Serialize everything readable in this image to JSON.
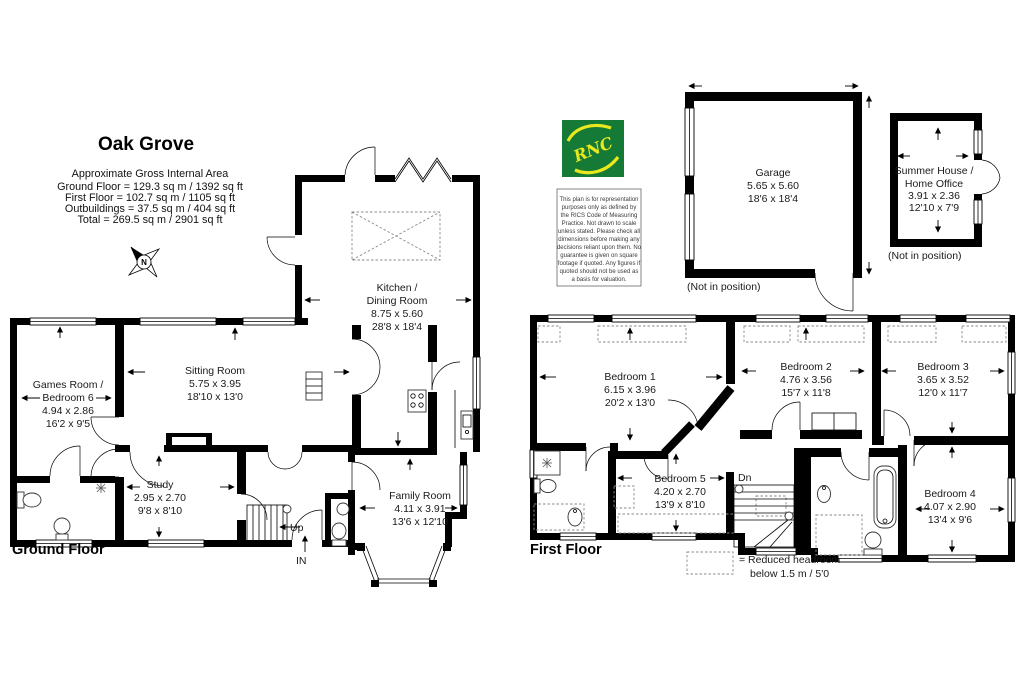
{
  "header": {
    "title": "Oak Grove",
    "area_heading": "Approximate Gross Internal Area",
    "area_lines": [
      "Ground Floor = 129.3 sq m / 1392 sq ft",
      "First Floor = 102.7 sq m / 1105 sq ft",
      "Outbuildings = 37.5 sq m / 404 sq ft",
      "Total = 269.5 sq m / 2901 sq ft"
    ]
  },
  "compass": {
    "label": "N"
  },
  "logo": {
    "text": "RNC",
    "green": "#157a35",
    "yellow": "#e9e81c"
  },
  "disclaimer_lines": [
    "This plan is for representation",
    "purposes only as defined by",
    "the RICS Code of Measuring",
    "Practice. Not drawn to scale",
    "unless stated. Please check all",
    "dimensions before making any",
    "decisions reliant upon them. No",
    "guarantee is given on square",
    "footage if quoted. Any figures if",
    "quoted should not be used as",
    "a basis for valuation."
  ],
  "ground_floor": {
    "label": "Ground Floor",
    "games_room": {
      "name1": "Games Room /",
      "name2": "Bedroom 6",
      "metric": "4.94 x 2.86",
      "imperial": "16'2 x 9'5"
    },
    "sitting_room": {
      "name": "Sitting Room",
      "metric": "5.75 x 3.95",
      "imperial": "18'10 x 13'0"
    },
    "kitchen": {
      "name1": "Kitchen /",
      "name2": "Dining Room",
      "metric": "8.75 x 5.60",
      "imperial": "28'8 x 18'4"
    },
    "study": {
      "name": "Study",
      "metric": "2.95 x 2.70",
      "imperial": "9'8 x 8'10"
    },
    "family_room": {
      "name": "Family Room",
      "metric": "4.11 x 3.91",
      "imperial": "13'6 x 12'10"
    },
    "up": "Up",
    "in": "IN"
  },
  "first_floor": {
    "label": "First Floor",
    "bedroom1": {
      "name": "Bedroom 1",
      "metric": "6.15 x 3.96",
      "imperial": "20'2 x 13'0"
    },
    "bedroom2": {
      "name": "Bedroom 2",
      "metric": "4.76 x 3.56",
      "imperial": "15'7 x 11'8"
    },
    "bedroom3": {
      "name": "Bedroom 3",
      "metric": "3.65 x 3.52",
      "imperial": "12'0 x 11'7"
    },
    "bedroom4": {
      "name": "Bedroom 4",
      "metric": "4.07 x 2.90",
      "imperial": "13'4 x 9'6"
    },
    "bedroom5": {
      "name": "Bedroom 5",
      "metric": "4.20 x 2.70",
      "imperial": "13'9 x 8'10"
    },
    "dn": "Dn"
  },
  "outbuildings": {
    "garage": {
      "name": "Garage",
      "metric": "5.65 x 5.60",
      "imperial": "18'6 x 18'4",
      "note": "(Not in position)"
    },
    "summer_house": {
      "name1": "Summer House /",
      "name2": "Home Office",
      "metric": "3.91 x 2.36",
      "imperial": "12'10 x 7'9",
      "note": "(Not in position)"
    }
  },
  "legend": {
    "line1": "=  Reduced headroom",
    "line2": "below 1.5 m / 5'0"
  }
}
